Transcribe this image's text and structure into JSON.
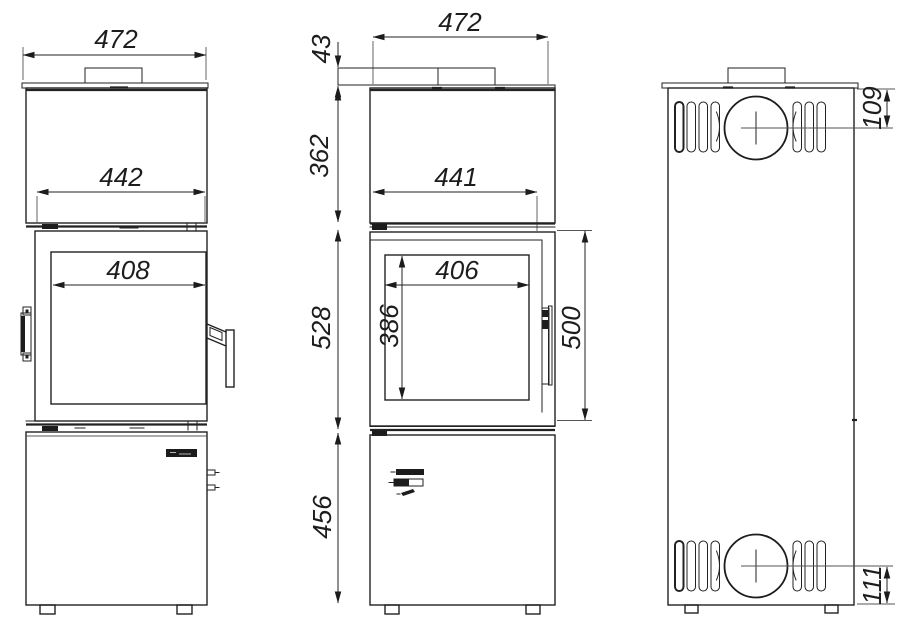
{
  "drawing": {
    "background_color": "#ffffff",
    "line_color": "#222222",
    "views": {
      "front": {
        "dims": {
          "overall_width": "472",
          "firebox_width": "442",
          "glass_width": "408"
        }
      },
      "side": {
        "dims": {
          "overall_width": "472",
          "top_plate_height": "43",
          "upper_section_height": "362",
          "inner_width": "441",
          "glass_width": "406",
          "glass_height": "386",
          "door_section_height": "528",
          "door_opening_height": "500",
          "base_height": "456"
        }
      },
      "rear": {
        "dims": {
          "flue_center_from_top": "109",
          "outlet_center_from_bottom": "111"
        }
      }
    }
  }
}
